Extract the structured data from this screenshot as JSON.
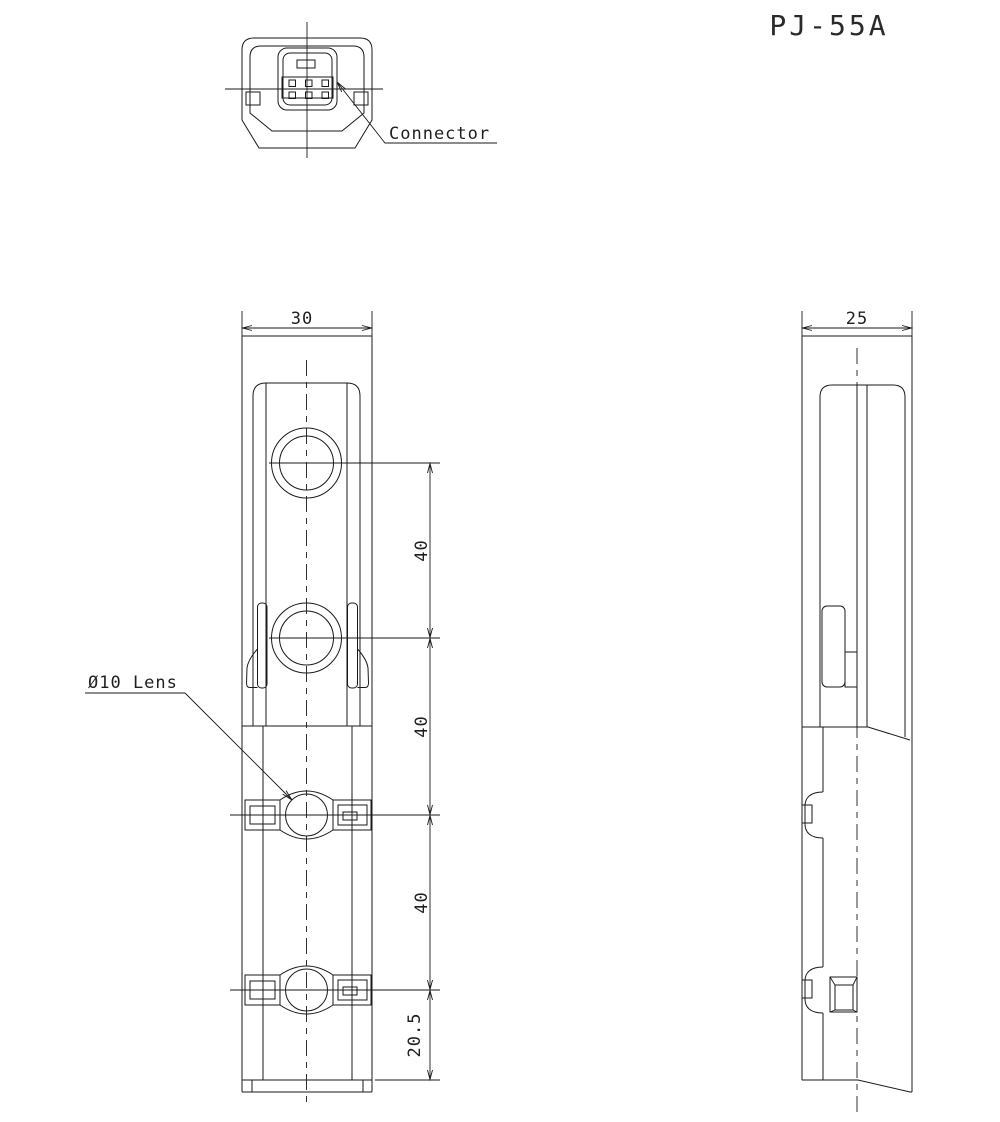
{
  "title": "PJ-55A",
  "connector_view": {
    "label": "Connector"
  },
  "front_view": {
    "lens_label": "Ø10 Lens",
    "dim_width": "30",
    "dim_pitch_1": "40",
    "dim_pitch_2": "40",
    "dim_pitch_3": "40",
    "dim_bottom": "20.5"
  },
  "side_view": {
    "dim_width": "25"
  },
  "colors": {
    "line": "#1a1a1a",
    "background": "#ffffff"
  }
}
